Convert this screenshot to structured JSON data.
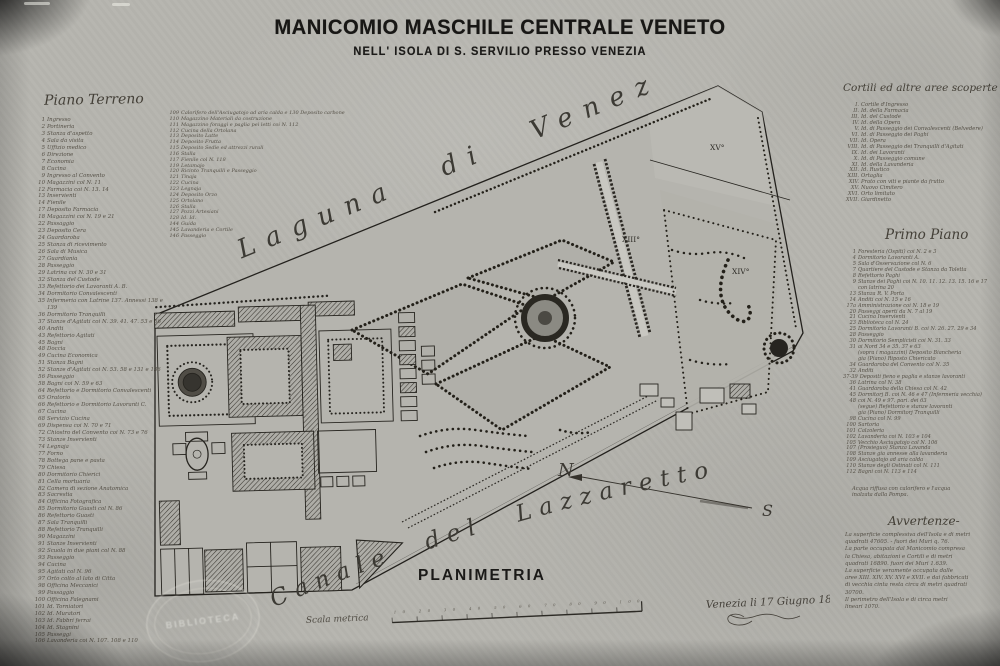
{
  "title": {
    "main": "MANICOMIO MASCHILE CENTRALE VENETO",
    "sub": "NELL' ISOLA DI S. SERVILIO PRESSO VENEZIA"
  },
  "piano_terreno": {
    "header": "Piano Terreno",
    "items": [
      {
        "n": "1",
        "t": "Ingresso"
      },
      {
        "n": "2",
        "t": "Portineria"
      },
      {
        "n": "3",
        "t": "Stanza d'aspetto"
      },
      {
        "n": "4",
        "t": "Sala da visita"
      },
      {
        "n": "5",
        "t": "Uffizio medico"
      },
      {
        "n": "6",
        "t": "Direzione"
      },
      {
        "n": "7",
        "t": "Economia"
      },
      {
        "n": "8",
        "t": "Cucina"
      },
      {
        "n": "9",
        "t": "Ingresso al Convento"
      },
      {
        "n": "10",
        "t": "Magazzini col N. 11"
      },
      {
        "n": "12",
        "t": "Farmacia coi N. 13. 14"
      },
      {
        "n": "13",
        "t": "Inservienti"
      },
      {
        "n": "14",
        "t": "Fienile"
      },
      {
        "n": "17",
        "t": "Deposito Farmacia"
      },
      {
        "n": "18",
        "t": "Magazzini coi N. 19 e 21"
      },
      {
        "n": "22",
        "t": "Passaggio"
      },
      {
        "n": "23",
        "t": "Deposito Cera"
      },
      {
        "n": "24",
        "t": "Guardaroba"
      },
      {
        "n": "25",
        "t": "Stanza di ricevimento"
      },
      {
        "n": "26",
        "t": "Sala di Musica"
      },
      {
        "n": "27",
        "t": "Guardiania"
      },
      {
        "n": "28",
        "t": "Passeggio"
      },
      {
        "n": "29",
        "t": "Latrina coi N. 30 e 31"
      },
      {
        "n": "32",
        "t": "Stanza del Custode"
      },
      {
        "n": "33",
        "t": "Refettorio dei Lavoranti A. B."
      },
      {
        "n": "34",
        "t": "Dormitorio Convalescenti"
      },
      {
        "n": "35",
        "t": "Infermeria con Latrine 137. Annessi 138 e 139"
      },
      {
        "n": "36",
        "t": "Dormitorio Tranquilli"
      },
      {
        "n": "37",
        "t": "Stanze d'Agitati coi N. 39. 41. 47. 53 e 56"
      },
      {
        "n": "40",
        "t": "Anditi"
      },
      {
        "n": "43",
        "t": "Refettorio Agitati"
      },
      {
        "n": "45",
        "t": "Bagni"
      },
      {
        "n": "48",
        "t": "Doccia"
      },
      {
        "n": "49",
        "t": "Cucina Economica"
      },
      {
        "n": "51",
        "t": "Stanza Bagni"
      },
      {
        "n": "52",
        "t": "Stanze d'Agitati coi N. 53. 58 e 131 e 136"
      },
      {
        "n": "56",
        "t": "Passeggio"
      },
      {
        "n": "58",
        "t": "Bagni coi N. 59 e 63"
      },
      {
        "n": "64",
        "t": "Refettorio e Dormitorio Convalescenti"
      },
      {
        "n": "65",
        "t": "Oratorio"
      },
      {
        "n": "66",
        "t": "Refettorio e Dormitorio Lavoranti C."
      },
      {
        "n": "67",
        "t": "Cucina"
      },
      {
        "n": "68",
        "t": "Servizio Cucina"
      },
      {
        "n": "69",
        "t": "Dispensa coi N. 70 e 71"
      },
      {
        "n": "72",
        "t": "Chiostro del Convento coi N. 73 e 76"
      },
      {
        "n": "73",
        "t": "Stanze Inservienti"
      },
      {
        "n": "74",
        "t": "Legnaja"
      },
      {
        "n": "77",
        "t": "Forno"
      },
      {
        "n": "78",
        "t": "Bottega pane e pasta"
      },
      {
        "n": "79",
        "t": "Chiesa"
      },
      {
        "n": "80",
        "t": "Dormitorio Chierici"
      },
      {
        "n": "81",
        "t": "Cella mortuaria"
      },
      {
        "n": "82",
        "t": "Camera di sezione Anatomica"
      },
      {
        "n": "83",
        "t": "Sacrestia"
      },
      {
        "n": "84",
        "t": "Officina Fotografica"
      },
      {
        "n": "85",
        "t": "Dormitorio Guasti col N. 86"
      },
      {
        "n": "86",
        "t": "Refettorio Guasti"
      },
      {
        "n": "87",
        "t": "Sala Tranquilli"
      },
      {
        "n": "88",
        "t": "Refettorio Tranquilli"
      },
      {
        "n": "90",
        "t": "Magazzini"
      },
      {
        "n": "91",
        "t": "Stanze Inservienti"
      },
      {
        "n": "92",
        "t": "Scuola in due piani col N. 88"
      },
      {
        "n": "93",
        "t": "Passeggio"
      },
      {
        "n": "94",
        "t": "Cucina"
      },
      {
        "n": "95",
        "t": "Agitati col N. 96"
      },
      {
        "n": "97",
        "t": "Orto colto al lato di Citta"
      },
      {
        "n": "98",
        "t": "Officina Meccanici"
      },
      {
        "n": "99",
        "t": "Passaggio"
      },
      {
        "n": "100",
        "t": "Officina Falegnami"
      },
      {
        "n": "101",
        "t": "Id. Torniatori"
      },
      {
        "n": "102",
        "t": "Id. Muratori"
      },
      {
        "n": "103",
        "t": "Id. Fabbri ferrai"
      },
      {
        "n": "104",
        "t": "Id. Stagnini"
      },
      {
        "n": "105",
        "t": "Passeggi"
      },
      {
        "n": "106",
        "t": "Lavanderia coi N. 107. 108 e 110"
      }
    ]
  },
  "piano_terreno_col2": {
    "items": [
      {
        "n": "109",
        "t": "Calorifero dell'Asciugatojo ad aria calda e 130 Deposito carbone"
      },
      {
        "n": "110",
        "t": "Magazzino Materiali da costruzione"
      },
      {
        "n": "111",
        "t": "Magazzino foraggi e paglia pei letti coi N. 112"
      },
      {
        "n": "112",
        "t": "Cucina della Ortolana"
      },
      {
        "n": "113",
        "t": "Deposito Latte"
      },
      {
        "n": "114",
        "t": "Deposito Frutta"
      },
      {
        "n": "115",
        "t": "Deposito Sedie ed attrezzi rurali"
      },
      {
        "n": "116",
        "t": "Stalla"
      },
      {
        "n": "117",
        "t": "Fienile col N. 118"
      },
      {
        "n": "119",
        "t": "Letamajo"
      },
      {
        "n": "120",
        "t": "Ricinto Tranquilli e Passeggio"
      },
      {
        "n": "121",
        "t": "Tinaja"
      },
      {
        "n": "122",
        "t": "Cucina"
      },
      {
        "n": "123",
        "t": "Legnaja"
      },
      {
        "n": "124",
        "t": "Deposito Orzo"
      },
      {
        "n": "125",
        "t": "Ortolano"
      },
      {
        "n": "126",
        "t": "Stalla"
      },
      {
        "n": "127",
        "t": "Pozzi Artesiani"
      },
      {
        "n": "128",
        "t": "Id.   Id."
      },
      {
        "n": "144",
        "t": "Guida"
      },
      {
        "n": "145",
        "t": "Lavanderia e Cortile"
      },
      {
        "n": "146",
        "t": "Passeggio"
      }
    ]
  },
  "cortili": {
    "header": "Cortili ed altre aree scoperte",
    "items": [
      {
        "n": "I.",
        "t": "Cortile d'Ingresso"
      },
      {
        "n": "II.",
        "t": "Id.  della Farmacia"
      },
      {
        "n": "III.",
        "t": "Id.  del Custode"
      },
      {
        "n": "IV.",
        "t": "Id.  della Opera"
      },
      {
        "n": "V.",
        "t": "Id.  di Passeggio dei Convalescenti (Belvedere)"
      },
      {
        "n": "VI.",
        "t": "Id.  di Passeggio dei Paghi"
      },
      {
        "n": "VII.",
        "t": "Id.  Opera"
      },
      {
        "n": "VIII.",
        "t": "Id.  di Passeggio dei Tranquilli d'Agitati"
      },
      {
        "n": "IX.",
        "t": "Id.  dei Lavoranti"
      },
      {
        "n": "X.",
        "t": "Id.  di Passeggio comune"
      },
      {
        "n": "XI.",
        "t": "Id.  della Lavanderia"
      },
      {
        "n": "XII.",
        "t": "Id.  Rustico"
      },
      {
        "n": "XIII.",
        "t": "Ortaglia"
      },
      {
        "n": "XIV.",
        "t": "Prato con viti e piante da frutto"
      },
      {
        "n": "XV.",
        "t": "Nuovo Cimitero"
      },
      {
        "n": "XVI.",
        "t": "Orto limitato"
      },
      {
        "n": "XVII.",
        "t": "Giardinetto"
      }
    ]
  },
  "primo_piano": {
    "header": "Primo Piano",
    "items": [
      {
        "n": "1",
        "t": "Foresteria (Ospiti) coi N. 2 e 3"
      },
      {
        "n": "4",
        "t": "Dormitorio Lavoranti A."
      },
      {
        "n": "5",
        "t": "Sala d'Osservazione col N. 6"
      },
      {
        "n": "7",
        "t": "Quartiere del Custode e Stanza da Toletta"
      },
      {
        "n": "8",
        "t": "Refettorio Paghi"
      },
      {
        "n": "9",
        "t": "Stanze dei Paghi coi N. 10. 11. 12. 13. 15. 16 e 17 con latrina 20"
      },
      {
        "n": "13",
        "t": "Stanza R. V. Porta"
      },
      {
        "n": "14",
        "t": "Anditi coi N. 15 e 16"
      },
      {
        "n": "17a",
        "t": "Amministrazione coi N. 18 e 19"
      },
      {
        "n": "20",
        "t": "Passeggi aperti da N. 7 al 19"
      },
      {
        "n": "21",
        "t": "Cucina Inservienti"
      },
      {
        "n": "23",
        "t": "Biblioteca col N. 24"
      },
      {
        "n": "25",
        "t": "Dormitorio Lavoranti B. coi N. 26. 27. 29 e 34"
      },
      {
        "n": "28",
        "t": "Passeggio"
      },
      {
        "n": "30",
        "t": "Dormitorio Semplicisti coi N. 31. 33"
      },
      {
        "n": "31",
        "t": "ai Nord 34 e 35. 37 e 63"
      },
      {
        "n": "",
        "t": "(sopra i magazzini) Deposito Biancheria"
      },
      {
        "n": "",
        "t": "gia (Piano) Riposto Chiericato"
      },
      {
        "n": "34",
        "t": "Guardaroba del Convento col N. 35"
      },
      {
        "n": "32",
        "t": "Anditi"
      },
      {
        "n": "37-39",
        "t": "Depositi fieno e paglia e stanze lavoranti"
      },
      {
        "n": "36",
        "t": "Latrina col N. 38"
      },
      {
        "n": "41",
        "t": "Guardaroba della Chiesa col N. 42"
      },
      {
        "n": "45",
        "t": "Dormitorj B. coi N. 46 e 47 (Infermeria vecchia)"
      },
      {
        "n": "48",
        "t": "coi N. 49 e 97. pari. dei 63"
      },
      {
        "n": "",
        "t": "(segue) Refettorio e stanze lavoranti"
      },
      {
        "n": "",
        "t": "gia (Piano) Dormitorj Tranquilli"
      },
      {
        "n": "98",
        "t": "Cucina col N. 99"
      },
      {
        "n": "100",
        "t": "Sartoria"
      },
      {
        "n": "101",
        "t": "Calzoleria"
      },
      {
        "n": "102",
        "t": "Lavanderia coi N. 103 e 104"
      },
      {
        "n": "105",
        "t": "Vecchio Asciugatojo col N. 106"
      },
      {
        "n": "107",
        "t": "(Prosieguo) Stanza Lavanda"
      },
      {
        "n": "108",
        "t": "Stanze gia annesse alla lavanderia"
      },
      {
        "n": "109",
        "t": "Asciugatojo ad aria calda"
      },
      {
        "n": "110",
        "t": "Stanze degli Ostinati col N. 111"
      },
      {
        "n": "112",
        "t": "Bagni coi N. 113 e 114"
      }
    ]
  },
  "nota": {
    "lines": [
      "Acqua riffusa con calorifero e l'acqua",
      "inalzata dalla Pompa."
    ]
  },
  "avvertenze": {
    "header": "Avvertenze-",
    "lines": [
      "La superficie complessiva dell'Isola e di metri",
      "quadrati 47605. - fuori dei Muri q. 76.",
      "La parte occupata dal Manicomio compresa",
      "la Chiesa, abitazioni e Cortili e di metri",
      "quadrati 16890. fuori dei Muri 1.639.",
      "La superficie veramente occupata dalle",
      "aree XIII. XIV. XV. XVI e XVII. e dai fabbricati",
      "di vecchia cinta resta circa di metri quadrati",
      "30700.",
      "Il perimetro dell'Isola e di circa metri",
      "lineari 1070."
    ]
  },
  "map": {
    "laguna_label": "Laguna di Venezia",
    "canale_label": "Canale del Lazzaretto",
    "north": "N",
    "south": "S",
    "planimetria": "PLANIMETRIA",
    "scala_label": "Scala metrica",
    "scale_numbers": "10  20  30  40  50  60  70  80  90  100",
    "area_labels": [
      {
        "text": "XIII°"
      },
      {
        "text": "XIV°"
      },
      {
        "text": "XV°"
      }
    ]
  },
  "footer": {
    "date_line": "Venezia li 17 Giugno 1882"
  },
  "stamp": {
    "center": "BIBLIOTECA"
  },
  "colors": {
    "paper": "#b6b5af",
    "ink": "#26241f",
    "handwriting": "#55514a"
  }
}
